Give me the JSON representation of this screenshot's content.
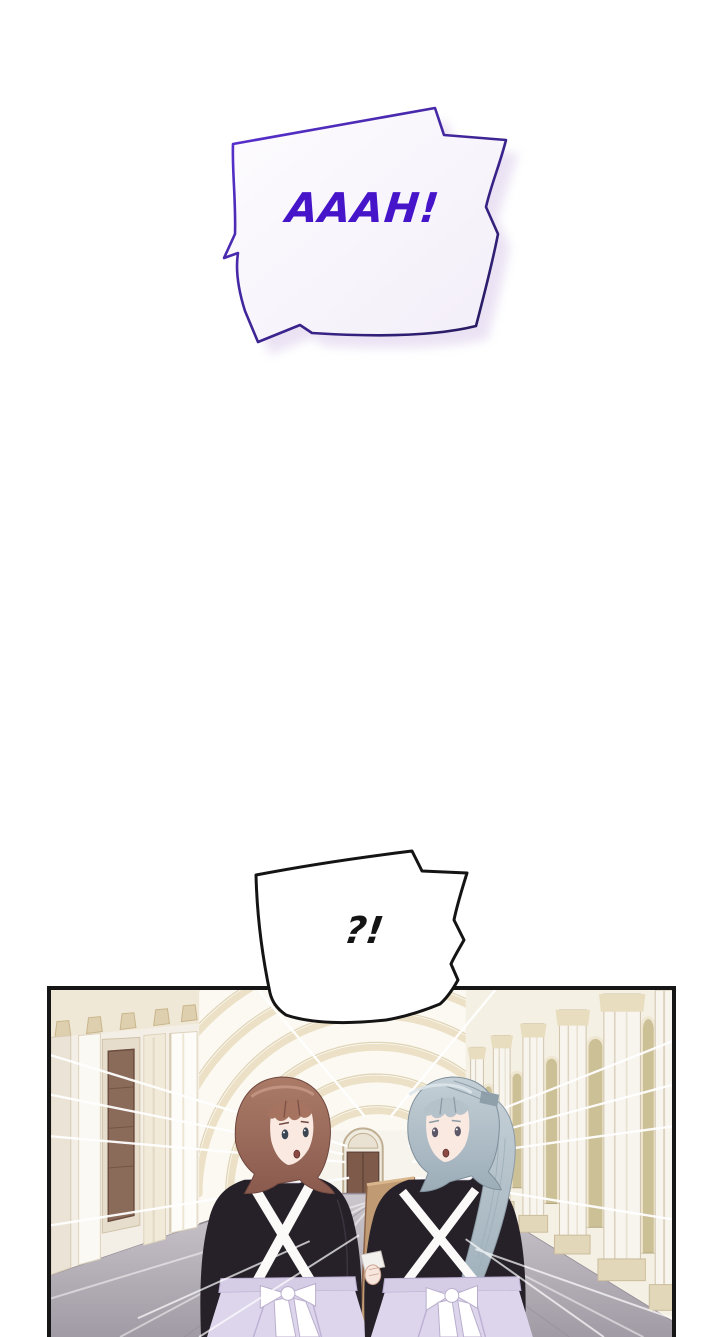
{
  "page": {
    "width": 720,
    "height": 1337,
    "background": "#ffffff"
  },
  "bubbles": {
    "shout": {
      "text": "AAAH!",
      "text_color": "#4715c9",
      "outline_color_start": "#5b31d8",
      "outline_color_end": "#241a58",
      "fill": "#faf8fd",
      "shadow_color": "#e7def2",
      "shape": "jagged-shout-bubble"
    },
    "surprise": {
      "text": "?!",
      "text_color": "#141414",
      "outline_color": "#141414",
      "fill": "#ffffff",
      "shape": "jagged-shout-bubble"
    }
  },
  "panel": {
    "border_color": "#161616",
    "scene": {
      "setting": "palace corridor with nested receding arches, side colonnade and a far double door",
      "palette": {
        "wall_cream": "#f4efe6",
        "arch_cream": "#ece1c6",
        "floor_gray": "#a8a2ab",
        "end_door_brown": "#7d5a4a",
        "side_door_brown": "#8a6a58",
        "window_olive": "#ccc096",
        "speed_lines": "#ffffff"
      },
      "characters": [
        {
          "id": "left-maid",
          "hair": "auburn bob",
          "hair_color": "#9c6b5e",
          "dress": "black maid dress with white cross straps",
          "dress_color": "#262128",
          "apron_color": "#ddd5ec",
          "expression": "startled, looking back over shoulder"
        },
        {
          "id": "right-maid",
          "hair": "silver high ponytail",
          "hair_color": "#becad2",
          "dress": "black maid dress with white cross straps",
          "dress_color": "#262128",
          "apron_color": "#ddd5ec",
          "holding": "tan wooden board",
          "board_color": "#c09a73",
          "expression": "startled, looking back over shoulder"
        }
      ]
    }
  }
}
